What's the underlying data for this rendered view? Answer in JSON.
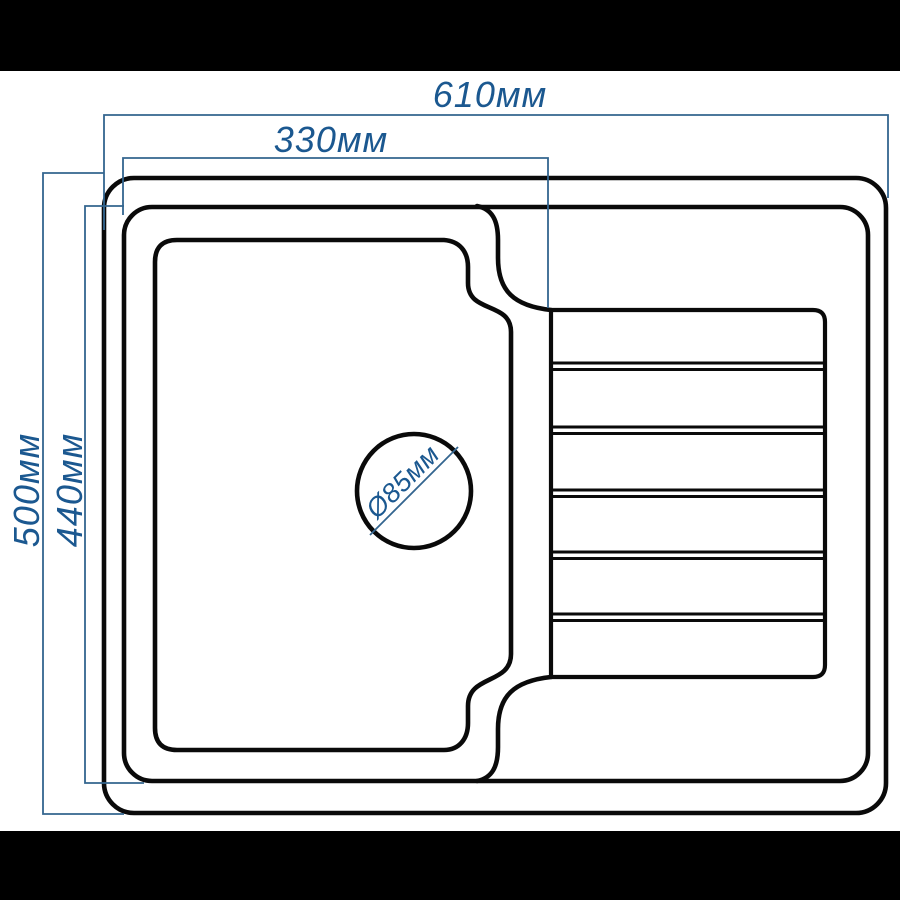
{
  "title": "Kitchen sink with drainboard — dimensioned top-view technical drawing",
  "labels": {
    "overall_width": "610мм",
    "bowl_width": "330мм",
    "overall_depth": "500мм",
    "rim_depth": "440мм",
    "drain_diameter": "Ø85мм"
  },
  "colors": {
    "outline": "#0a0a0a",
    "dimension_line": "#33658f",
    "dimension_text": "#1b5890",
    "background": "#ffffff",
    "letterbox": "#000000"
  }
}
